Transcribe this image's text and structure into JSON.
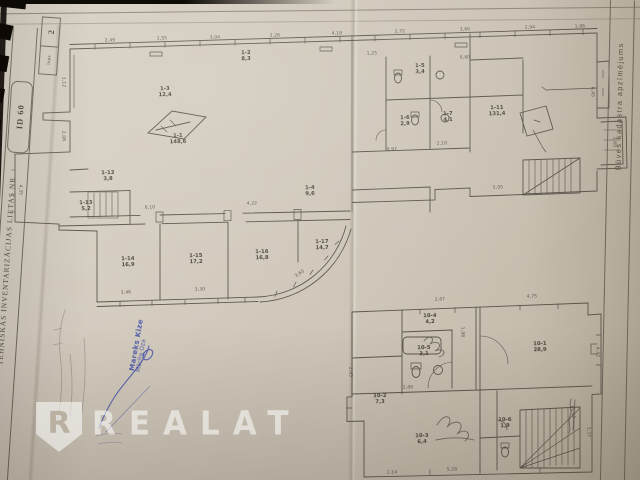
{
  "watermark": {
    "brand": "REALAT",
    "logo_letter": "R",
    "color": "#ffffff"
  },
  "edges": {
    "left_label": "TEHNISKĀS INVENTARIZĀCIJAS LIETAS NR",
    "left_number": "ID 60",
    "page_number": "2",
    "page_caption": "lapa",
    "right_label": "Būves kadastra apzīmējums"
  },
  "stamp": {
    "line1": "Mareks Kize",
    "line2": "Mārīte Oza",
    "ink_color": "#3448a6"
  },
  "plan": {
    "line_color": "#59534a",
    "paper_color": "#cfc7ba",
    "background_color": "#141008",
    "room_labels": [
      {
        "x": 178,
        "y": 140,
        "r": -2,
        "t": "1-1\n148,6"
      },
      {
        "x": 165,
        "y": 93,
        "r": -2,
        "t": "1-3\n12,4"
      },
      {
        "x": 246,
        "y": 57,
        "r": -2,
        "t": "1-2\n8,3"
      },
      {
        "x": 420,
        "y": 70,
        "r": -2,
        "t": "1-5\n3,4"
      },
      {
        "x": 405,
        "y": 122,
        "r": -2,
        "t": "1-6\n2,9"
      },
      {
        "x": 448,
        "y": 118,
        "r": -2,
        "t": "1-7\n4,1"
      },
      {
        "x": 497,
        "y": 112,
        "r": -2,
        "t": "1-11\n131,4"
      },
      {
        "x": 310,
        "y": 192,
        "r": -2,
        "t": "1-4\n9,6"
      },
      {
        "x": 128,
        "y": 263,
        "r": -2,
        "t": "1-14\n16,9"
      },
      {
        "x": 196,
        "y": 260,
        "r": -2,
        "t": "1-15\n17,2"
      },
      {
        "x": 262,
        "y": 256,
        "r": -2,
        "t": "1-16\n16,8"
      },
      {
        "x": 322,
        "y": 246,
        "r": -2,
        "t": "1-17\n14,7"
      },
      {
        "x": 86,
        "y": 207,
        "r": -2,
        "t": "1-13\n5,2"
      },
      {
        "x": 108,
        "y": 177,
        "r": -2,
        "t": "1-12\n3,8"
      },
      {
        "x": 430,
        "y": 320,
        "r": -2,
        "t": "10-4\n4,2"
      },
      {
        "x": 424,
        "y": 352,
        "r": -2,
        "t": "10-5\n3,1"
      },
      {
        "x": 380,
        "y": 400,
        "r": -2,
        "t": "10-2\n7,3"
      },
      {
        "x": 540,
        "y": 348,
        "r": -2,
        "t": "10-1\n28,9"
      },
      {
        "x": 422,
        "y": 440,
        "r": -2,
        "t": "10-3\n6,4"
      },
      {
        "x": 505,
        "y": 424,
        "r": -2,
        "t": "10-6\n1,9"
      }
    ],
    "dimensions": [
      {
        "x": 110,
        "y": 41,
        "r": -2,
        "t": "2,49"
      },
      {
        "x": 162,
        "y": 39,
        "r": -2,
        "t": "1,55"
      },
      {
        "x": 215,
        "y": 38,
        "r": -2,
        "t": "3,04"
      },
      {
        "x": 275,
        "y": 36,
        "r": -2,
        "t": "2,26"
      },
      {
        "x": 337,
        "y": 34,
        "r": -2,
        "t": "4,18"
      },
      {
        "x": 400,
        "y": 32,
        "r": -2,
        "t": "2,72"
      },
      {
        "x": 465,
        "y": 30,
        "r": -2,
        "t": "3,60"
      },
      {
        "x": 530,
        "y": 28,
        "r": -2,
        "t": "2,94"
      },
      {
        "x": 580,
        "y": 27,
        "r": -2,
        "t": "1,86"
      },
      {
        "x": 63,
        "y": 82,
        "r": 88,
        "t": "3,12"
      },
      {
        "x": 63,
        "y": 136,
        "r": 88,
        "t": "2,08"
      },
      {
        "x": 20,
        "y": 190,
        "r": 88,
        "t": "4,35"
      },
      {
        "x": 150,
        "y": 208,
        "r": -2,
        "t": "6,10"
      },
      {
        "x": 252,
        "y": 204,
        "r": -2,
        "t": "4,22"
      },
      {
        "x": 126,
        "y": 293,
        "r": -2,
        "t": "3,46"
      },
      {
        "x": 200,
        "y": 290,
        "r": -2,
        "t": "3,30"
      },
      {
        "x": 300,
        "y": 274,
        "r": -32,
        "t": "3,65"
      },
      {
        "x": 498,
        "y": 188,
        "r": -2,
        "t": "5,05"
      },
      {
        "x": 592,
        "y": 92,
        "r": 88,
        "t": "6,45"
      },
      {
        "x": 614,
        "y": 142,
        "r": 88,
        "t": "1,60"
      },
      {
        "x": 372,
        "y": 54,
        "r": -2,
        "t": "1,25"
      },
      {
        "x": 442,
        "y": 144,
        "r": -2,
        "t": "2,10"
      },
      {
        "x": 392,
        "y": 150,
        "r": -2,
        "t": "0,97"
      },
      {
        "x": 465,
        "y": 58,
        "r": -2,
        "t": "0,80"
      },
      {
        "x": 440,
        "y": 300,
        "r": -2,
        "t": "2,67"
      },
      {
        "x": 532,
        "y": 297,
        "r": -2,
        "t": "4,75"
      },
      {
        "x": 597,
        "y": 352,
        "r": 88,
        "t": "4,42"
      },
      {
        "x": 588,
        "y": 432,
        "r": 88,
        "t": "3,37"
      },
      {
        "x": 452,
        "y": 470,
        "r": -1,
        "t": "5,28"
      },
      {
        "x": 392,
        "y": 473,
        "r": -1,
        "t": "2,14"
      },
      {
        "x": 350,
        "y": 372,
        "r": 88,
        "t": "2,45"
      },
      {
        "x": 408,
        "y": 388,
        "r": -2,
        "t": "2,89"
      },
      {
        "x": 462,
        "y": 332,
        "r": 88,
        "t": "1,98"
      },
      {
        "x": 572,
        "y": 412,
        "r": 80,
        "t": "15,00"
      }
    ]
  }
}
